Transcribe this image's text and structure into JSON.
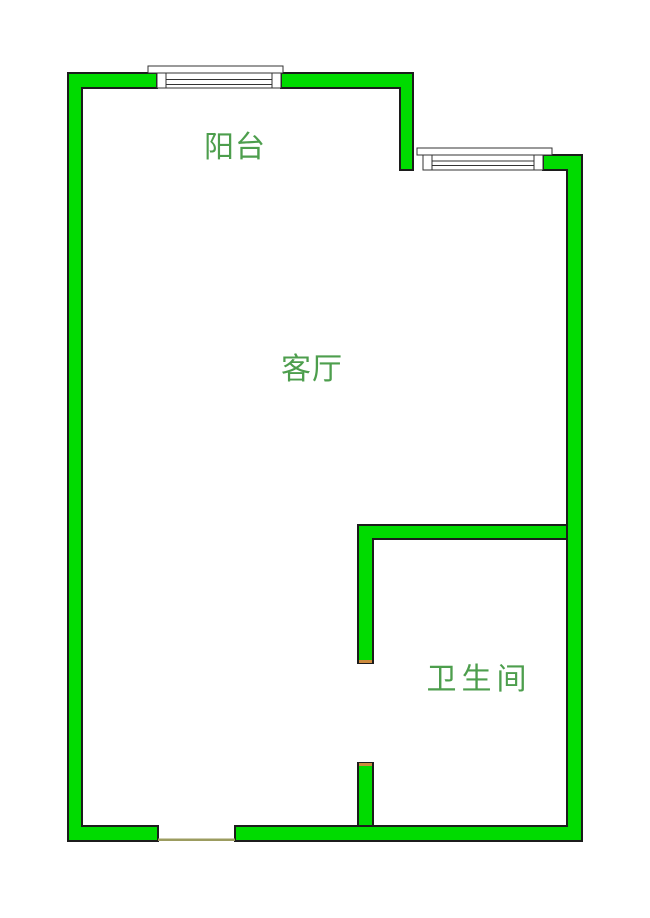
{
  "floorplan": {
    "rooms": [
      {
        "id": "balcony",
        "label": "阳台"
      },
      {
        "id": "living-room",
        "label": "客厅"
      },
      {
        "id": "bathroom",
        "label": "卫生间"
      }
    ],
    "icons": [
      {
        "name": "window-top-icon",
        "meaning": "window on balcony top wall"
      },
      {
        "name": "window-right-icon",
        "meaning": "window on upper right stepped wall"
      },
      {
        "name": "entry-opening",
        "meaning": "door opening in bottom wall"
      },
      {
        "name": "bathroom-opening",
        "meaning": "door opening in bathroom wall"
      }
    ],
    "colors": {
      "background": "#ffffff",
      "wall_fill": "#00db00",
      "wall_outline": "#1c1c1c",
      "window_fill": "#ffffff",
      "window_outline": "#333333",
      "label_text": "#4d9e4d",
      "door_cap": "#cc8a3d",
      "threshold": "#9c9c60"
    }
  }
}
